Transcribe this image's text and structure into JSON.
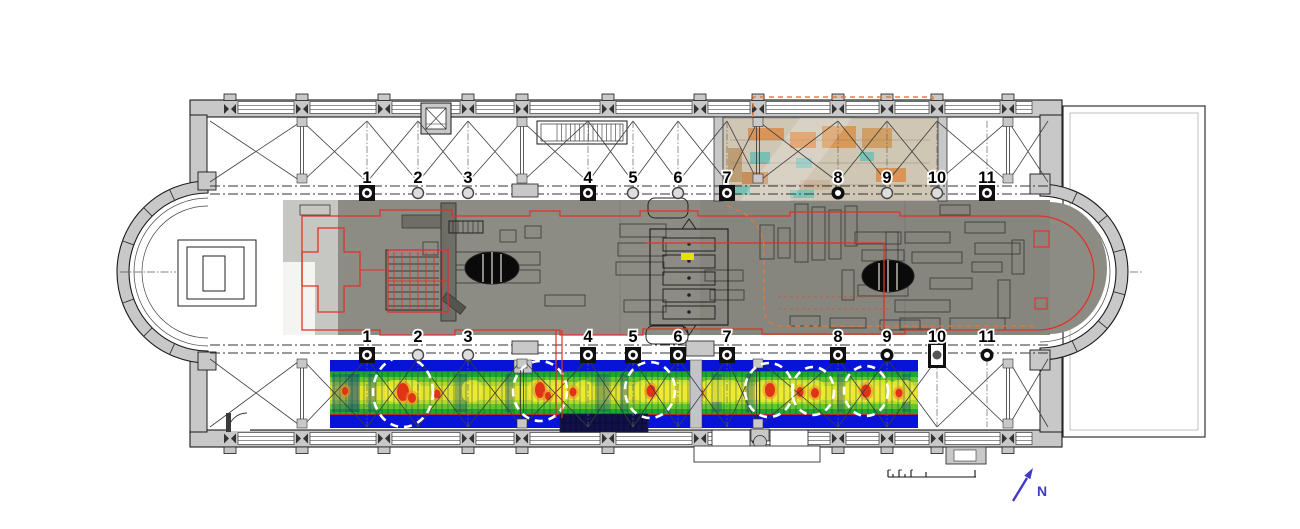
{
  "plan": {
    "column_labels_top": [
      "1",
      "2",
      "3",
      "4",
      "5",
      "6",
      "7",
      "8",
      "9",
      "10",
      "11"
    ],
    "column_labels_bottom": [
      "1",
      "2",
      "3",
      "4",
      "5",
      "6",
      "7",
      "8",
      "9",
      "10",
      "11"
    ],
    "compass_label": "N",
    "gpr_anomaly_circle_count": 6,
    "colors": {
      "wall_fill": "#c8c8c8",
      "heatmap_blue": "#0713d6",
      "heatmap_green": "#1ea82e",
      "heatmap_lightgreen": "#66c52e",
      "heatmap_yellowgreen": "#b4d82d",
      "heatmap_yellow": "#e3e22c",
      "anomaly_red": "#e13416",
      "anomaly_orange": "#f08a22",
      "trace_red": "#e03226",
      "trace_orange_dashed": "#e0763c",
      "photo_overlay_grey": "#8d8c84",
      "excavation_photo_tan": "#cfc6b4",
      "north_arrow_blue": "#4338cc",
      "highlight_yellow": "#e8e000",
      "anomaly_circle_white": "#ffffff"
    }
  }
}
